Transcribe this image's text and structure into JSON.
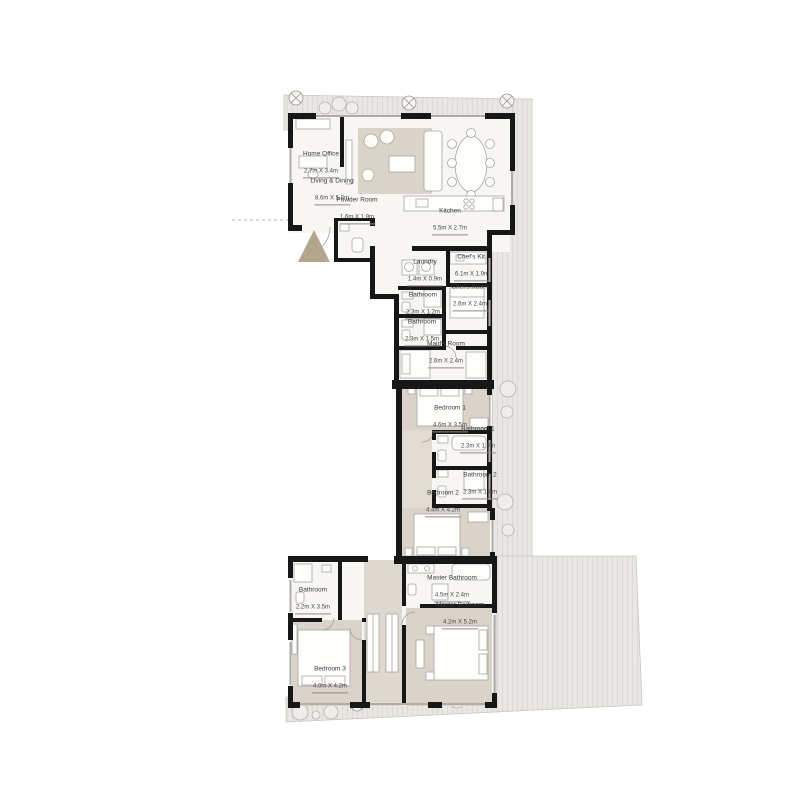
{
  "plan": {
    "kind": "apartment-floor-plan",
    "colors": {
      "wall": "#171717",
      "terrace": "#e9e7e3",
      "terrace_hatch": "#dedbd5",
      "floor": "#f7f6f3",
      "carpet": "#d9d3ca",
      "hall_carpet": "#ddd8d0",
      "entry_marker": "#b2a68b",
      "furniture_line": "#a9a6a0"
    },
    "rooms": [
      {
        "id": "home-office",
        "name": "Home Office",
        "dims": "2.7m X 3.4m"
      },
      {
        "id": "living-dining",
        "name": "Living & Dining",
        "dims": "8.6m X 5.8m"
      },
      {
        "id": "powder-room",
        "name": "Powder Room",
        "dims": "1.6m X 1.9m"
      },
      {
        "id": "kitchen",
        "name": "Kitchen",
        "dims": "5.5m X 2.7m"
      },
      {
        "id": "laundry",
        "name": "Laundry",
        "dims": "1.4m X 0.9m"
      },
      {
        "id": "chefs-kitchen",
        "name": "Chef's Kit.",
        "dims": "6.1m X 1.9m"
      },
      {
        "id": "bathroom-service-1",
        "name": "Bathroom",
        "dims": "2.3m X 1.2m"
      },
      {
        "id": "chefs-room",
        "name": "Chef's Room",
        "dims": "2.6m X 2.4m"
      },
      {
        "id": "bathroom-service-2",
        "name": "Bathroom",
        "dims": "2.3m X 1.5m"
      },
      {
        "id": "maids-room",
        "name": "Maid's Room",
        "dims": "2.6m X 2.4m"
      },
      {
        "id": "bedroom-1",
        "name": "Bedroom 1",
        "dims": "4.6m X 3.5m"
      },
      {
        "id": "bathroom-1",
        "name": "Bathroom 1",
        "dims": "2.3m X 1.9m"
      },
      {
        "id": "bathroom-2",
        "name": "Bathroom 2",
        "dims": "2.3m X 1.8m"
      },
      {
        "id": "bedroom-2",
        "name": "Bedroom 2",
        "dims": "4.4m X 4.2m"
      },
      {
        "id": "master-bathroom",
        "name": "Master Bathroom",
        "dims": "4.5m X 2.4m"
      },
      {
        "id": "master-bedroom",
        "name": "Master Bedroom",
        "dims": "4.2m X 5.2m"
      },
      {
        "id": "bathroom-3",
        "name": "Bathroom",
        "dims": "2.2m X 3.5m"
      },
      {
        "id": "bedroom-3",
        "name": "Bedroom 3",
        "dims": "4.0m X 4.2m"
      }
    ]
  }
}
